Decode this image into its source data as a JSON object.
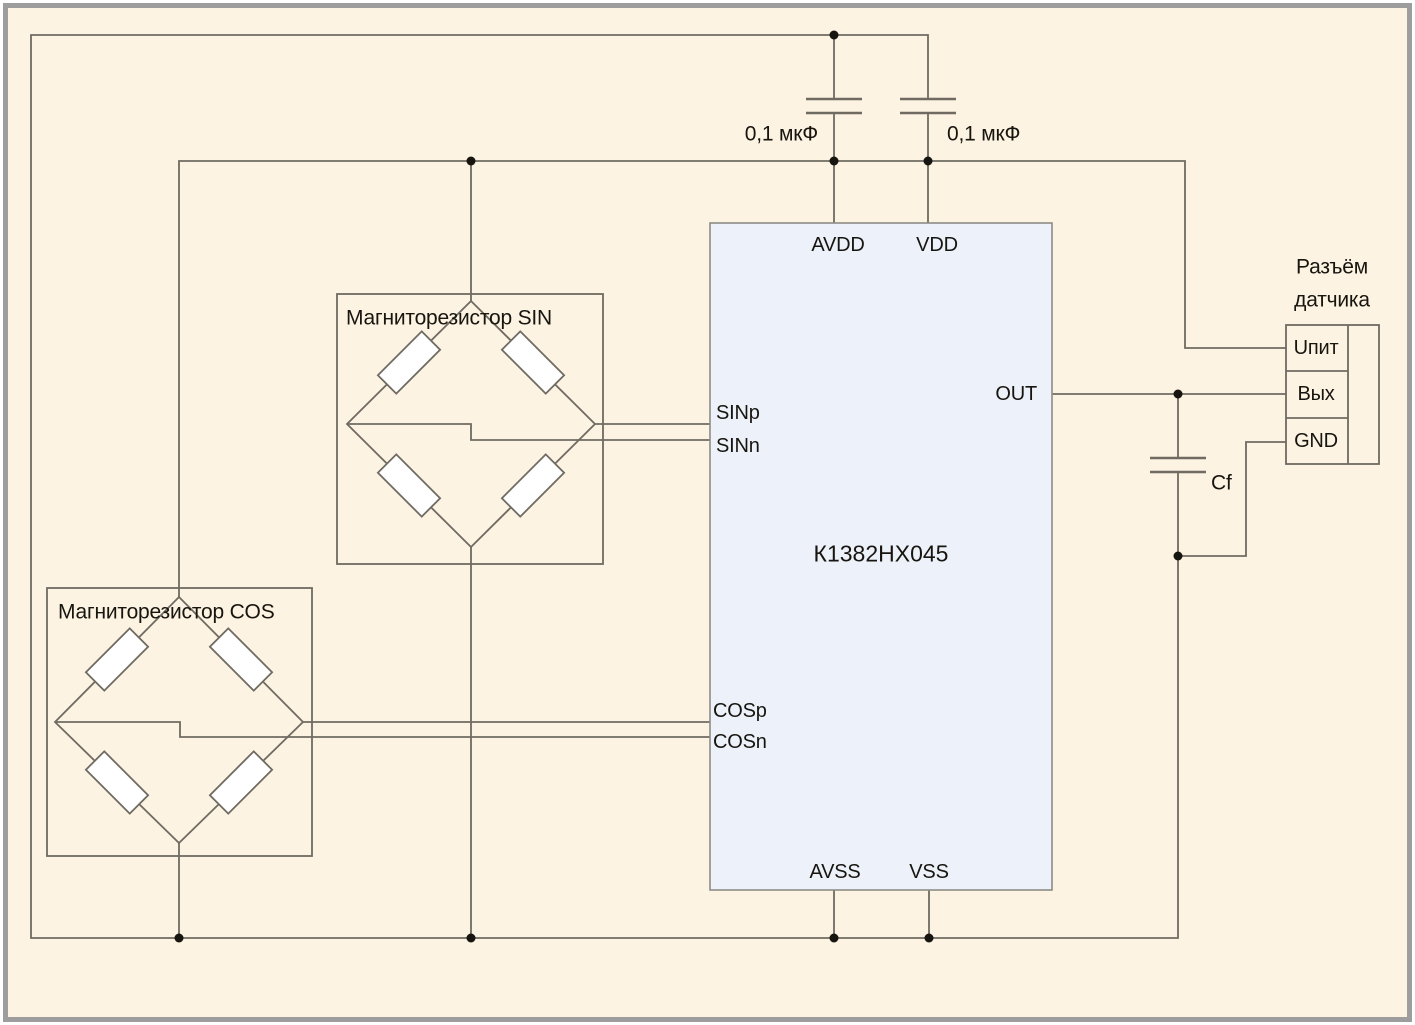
{
  "diagram_title": "Typical connection circuit of magnetoresistive bridges to K1382NX045",
  "chip": {
    "name": "К1382НХ045",
    "pins": {
      "avdd": "AVDD",
      "vdd": "VDD",
      "sinp": "SINp",
      "sinn": "SINn",
      "cosp": "COSp",
      "cosn": "COSn",
      "out": "OUT",
      "avss": "AVSS",
      "vss": "VSS"
    }
  },
  "bridges": {
    "sin": {
      "label": "Магниторезистор SIN"
    },
    "cos": {
      "label": "Магниторезистор COS"
    }
  },
  "capacitors": {
    "c1": "0,1 мкФ",
    "c2": "0,1 мкФ",
    "cf": "Cf"
  },
  "connector": {
    "title_line1": "Разъём",
    "title_line2": "датчика",
    "pins": [
      "Uпит",
      "Вых",
      "GND"
    ]
  },
  "colors": {
    "background": "#fdf3e2",
    "frame": "#9d9d9d",
    "wire": "#6f6b62",
    "chip_fill": "#edf1f9",
    "chip_border": "#8c8c86",
    "resistor_fill": "#ffffff",
    "text": "#17150f"
  }
}
